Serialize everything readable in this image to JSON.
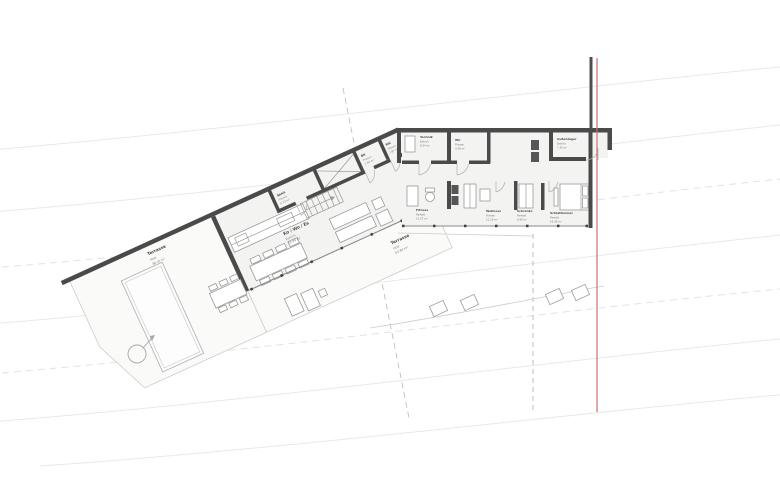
{
  "drawing": {
    "type": "floor-plan",
    "style": "architectural ground floor plan on sloped site with contour lines"
  },
  "rooms": [
    {
      "name": "Ko / Wo / Es",
      "material": "Estrich",
      "area": "79.99 m²"
    },
    {
      "name": "Speis",
      "material": "Fliesen",
      "area": "6.73 m²"
    },
    {
      "name": "BK",
      "material": "Fliesen",
      "area": "1.94 m²"
    },
    {
      "name": "WC",
      "material": "Fliesen",
      "area": "2.97 m²"
    },
    {
      "name": "Technik",
      "material": "Estrich",
      "area": "8.54 m²"
    },
    {
      "name": "WC",
      "material": "Fliesen",
      "area": "3.46 m²"
    },
    {
      "name": "Außenlager",
      "material": "Estrich",
      "area": "7.35 m²"
    },
    {
      "name": "Fitness",
      "material": "Parkett",
      "area": "13.27 m²"
    },
    {
      "name": "Wellness",
      "material": "Fliesen",
      "area": "10.18 m²"
    },
    {
      "name": "Schrankr.",
      "material": "Parkett",
      "area": "6.89 m²"
    },
    {
      "name": "Schlafzimmer",
      "material": "Parkett",
      "area": "16.98 m²"
    }
  ],
  "terraces": [
    {
      "name": "Terrasse",
      "material": "Holz",
      "area": "38.10 m²"
    },
    {
      "name": "Terrasse",
      "material": "Holz",
      "area": "52.84 m²"
    }
  ],
  "colors": {
    "wall": "#4a4a4a",
    "floor": "#f3f3f1",
    "deck": "#fafaf8",
    "contour": "#e9e9e9",
    "boundary_red": "#cc7070"
  }
}
